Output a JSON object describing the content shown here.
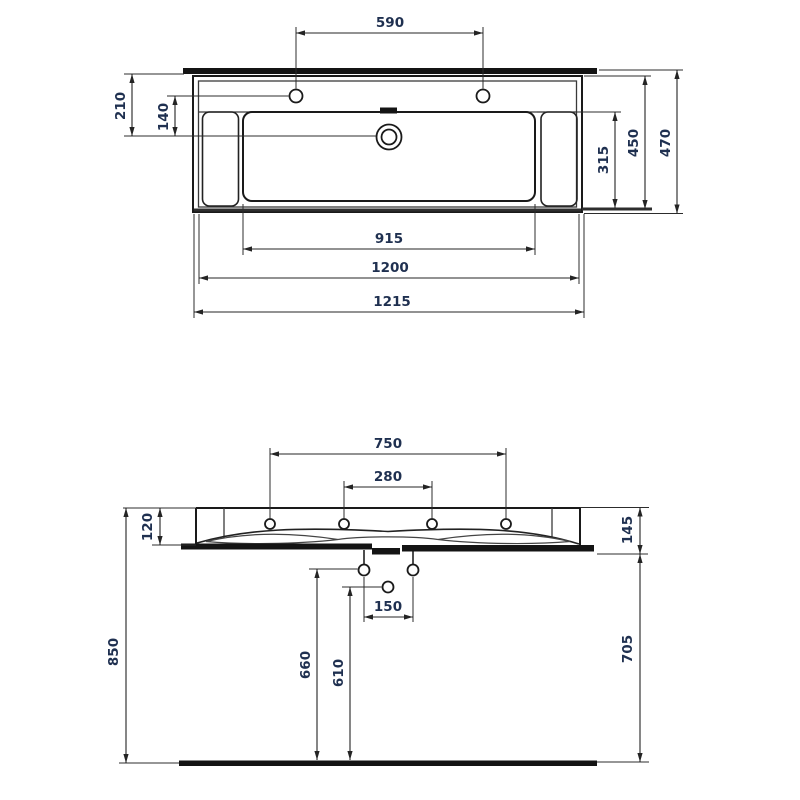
{
  "meta": {
    "description": "Technical dimension drawing of a rectangular washbasin: top (plan) view and front (elevation) view",
    "units_implied": "mm"
  },
  "colors": {
    "outline": "#1a1a1a",
    "dimension_line": "#242424",
    "dimension_text": "#1f3050",
    "solid_fill": "#141414",
    "background": "#ffffff"
  },
  "top_view": {
    "faucet_hole_spacing": "590",
    "back_edge_to_drain": "210",
    "faucet_line_to_drain": "140",
    "bowl_front_to_back": "315",
    "basin_depth": "450",
    "overall_depth": "470",
    "bowl_width": "915",
    "rim_width": "1200",
    "overall_width": "1215"
  },
  "front_view": {
    "outer_faucet_hole_spacing": "750",
    "inner_faucet_hole_spacing": "280",
    "rim_thickness": "120",
    "front_apron_height": "145",
    "supply_hole_spacing": "150",
    "supply_hole_height": "660",
    "drain_outlet_height": "610",
    "rim_height_from_floor": "850",
    "underside_height_from_floor": "705"
  }
}
